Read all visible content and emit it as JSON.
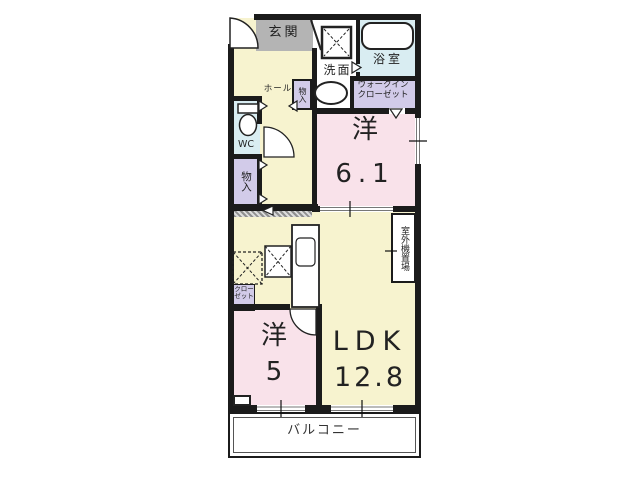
{
  "palette": {
    "wall": "#1b1b1b",
    "room_cream": "#f7f3cf",
    "room_pink": "#f9e2ea",
    "room_blue": "#d9edf2",
    "room_lavender": "#d2cbe9",
    "genkan_gray": "#b4b4b4",
    "text": "#222222"
  },
  "floorplan": {
    "rooms": {
      "genkan": {
        "label": "玄関"
      },
      "hall": {
        "label": "ホール"
      },
      "washroom": {
        "label": "洗面"
      },
      "bathroom": {
        "label": "浴室"
      },
      "walkin_closet": {
        "label": "ウォークイン\nクローゼット"
      },
      "wc": {
        "label": "WC"
      },
      "storage_top": {
        "label": "物入"
      },
      "storage_left": {
        "label": "物入"
      },
      "western_room_61": {
        "label": "洋",
        "size": "6.1"
      },
      "outdoor_unit_space": {
        "label": "室外機置場"
      },
      "small_closet": {
        "label": "クロー\nゼット"
      },
      "western_room_5": {
        "label": "洋",
        "size": "5"
      },
      "ldk": {
        "label": "LDK",
        "size": "12.8"
      },
      "balcony": {
        "label": "バルコニー"
      }
    },
    "fixture_icons": [
      "bathtub-icon",
      "washing-machine-pan-icon",
      "sink-icon",
      "toilet-icon",
      "kitchen-counter-icon",
      "appliance-space-icon",
      "door-arc-icon",
      "window-icon"
    ]
  }
}
